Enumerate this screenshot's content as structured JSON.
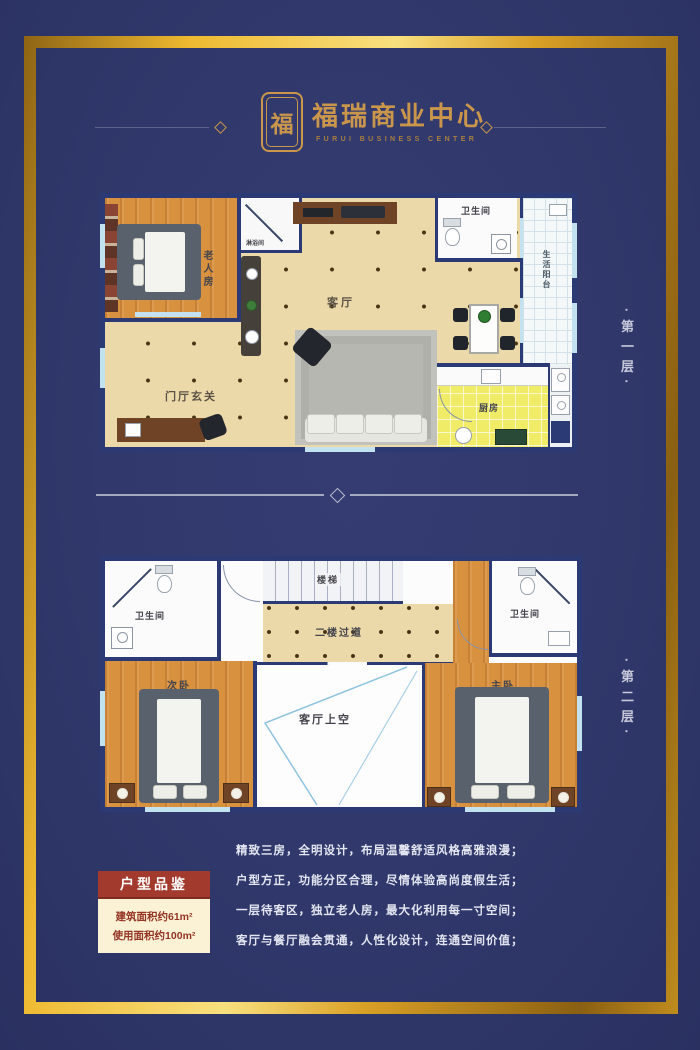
{
  "colors": {
    "background": "#30386b",
    "frame_gold": "#eeb930",
    "wall_navy": "#2b3a74",
    "wood_floor": "#d8913f",
    "tile_beige": "#ecd9a9",
    "kitchen_yellow": "#f0ec68",
    "badge_red": "#a23b2d",
    "panel_cream": "#fbf2d5",
    "text_gold": "#c9964b"
  },
  "header": {
    "logo_char": "福",
    "title": "福瑞商业中心",
    "subtitle": "FURUI BUSINESS CENTER"
  },
  "floor1": {
    "side_label": "·第一层·",
    "rooms": {
      "elder": "老人房",
      "shower": "淋浴间",
      "living": "客厅",
      "bath": "卫生间",
      "balcony": "生活阳台",
      "kitchen": "厨房",
      "foyer": "门厅玄关"
    }
  },
  "floor2": {
    "side_label": "·第二层·",
    "rooms": {
      "bath_left": "卫生间",
      "second_bedroom": "次卧",
      "stairs": "楼梯",
      "corridor": "二楼过道",
      "void": "客厅上空",
      "bath_right": "卫生间",
      "master_bedroom": "主卧"
    }
  },
  "info": {
    "badge": "户型品鉴",
    "area_building": "建筑面积约61m²",
    "area_usable": "使用面积约100m²",
    "desc": [
      "精致三房，全明设计，布局温馨舒适风格高雅浪漫；",
      "户型方正，功能分区合理，尽情体验高尚度假生活；",
      "一层待客区，独立老人房，最大化利用每一寸空间；",
      "客厅与餐厅融会贯通，人性化设计，连通空间价值；"
    ]
  }
}
